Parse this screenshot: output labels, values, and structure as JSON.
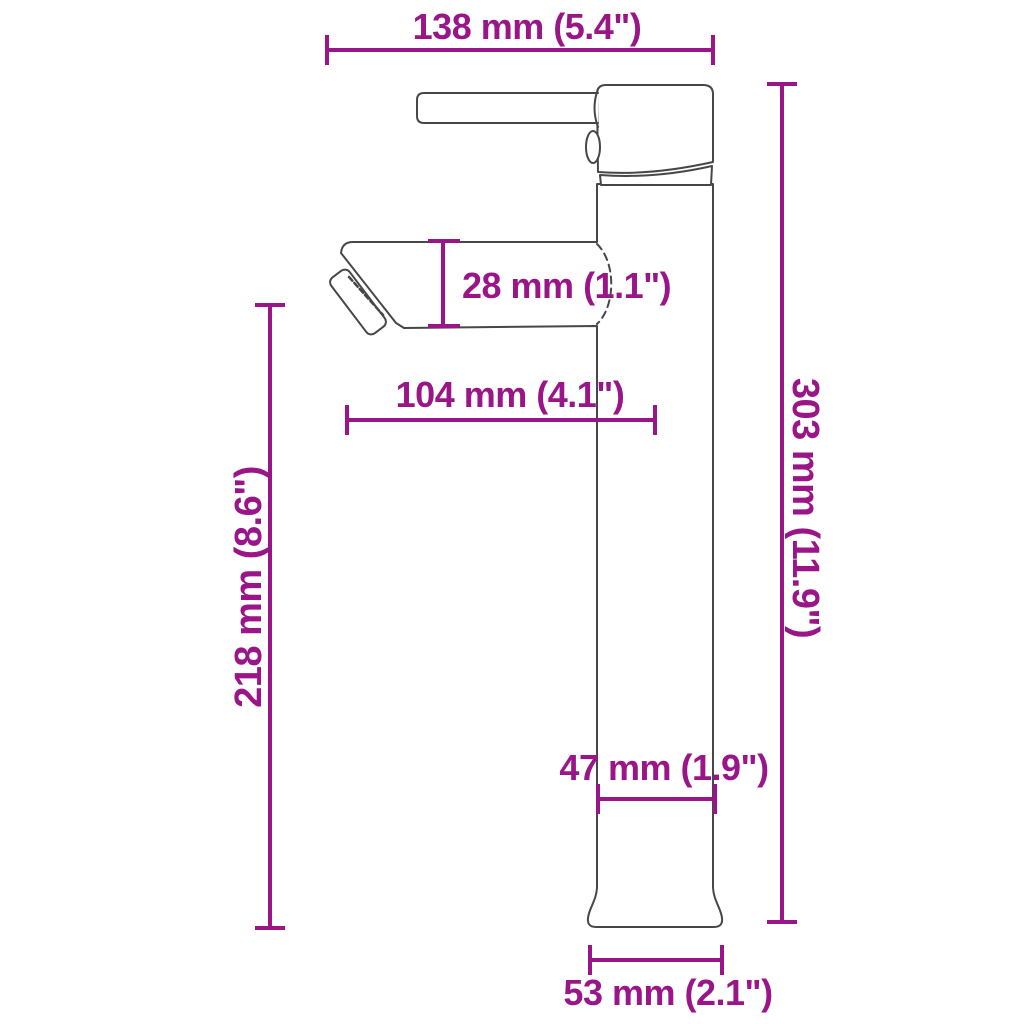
{
  "diagram": {
    "accent_color": "#9A1688",
    "outline_color": "#474747",
    "background_color": "#FFFFFF",
    "dimensions": {
      "total_width": {
        "label": "138 mm (5.4\")"
      },
      "spout_height": {
        "label": "28 mm (1.1\")"
      },
      "spout_reach": {
        "label": "104 mm (4.1\")"
      },
      "clearance_height": {
        "label": "218 mm (8.6\")"
      },
      "total_height": {
        "label": "303 mm (11.9\")"
      },
      "body_width": {
        "label": "47 mm (1.9\")"
      },
      "base_width": {
        "label": "53 mm (2.1\")"
      }
    }
  }
}
